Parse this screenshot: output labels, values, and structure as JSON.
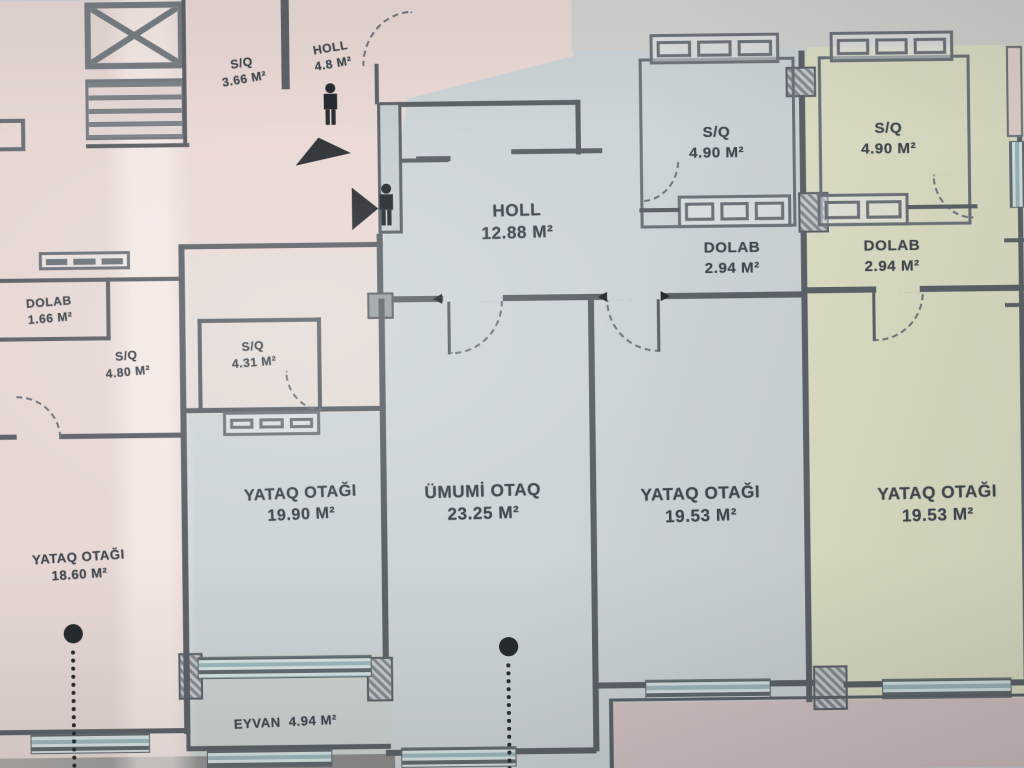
{
  "plan": {
    "title": "Apartment floor plan (photo)",
    "language": "Azerbaijani",
    "colors": {
      "left_apartment_fill": "#ebdad6",
      "center_apartment_fill": "#ced5d8",
      "right_apartment_fill": "#e2e3c6",
      "balcony_fill": "#dac7c7",
      "wall": "#5b6269",
      "text": "#3f464e"
    },
    "icons": {
      "person": "person-silhouette",
      "entry_arrow_up": "triangle-arrow-up",
      "entry_arrow_right": "triangle-arrow-right",
      "column_dot": "column-dot-with-dotted-axis"
    },
    "rooms": [
      {
        "name": "S/Q",
        "area": "3.66 M²"
      },
      {
        "name": "HOLL",
        "area": "4.8 M²"
      },
      {
        "name": "HOLL",
        "area": "12.88 M²"
      },
      {
        "name": "S/Q",
        "area": "4.90 M²"
      },
      {
        "name": "S/Q",
        "area": "4.90 M²"
      },
      {
        "name": "DOLAB",
        "area": "2.94 M²"
      },
      {
        "name": "DOLAB",
        "area": "2.94 M²"
      },
      {
        "name": "DOLAB",
        "area": "1.66 M²"
      },
      {
        "name": "S/Q",
        "area": "4.80 M²"
      },
      {
        "name": "S/Q",
        "area": "4.31 M²"
      },
      {
        "name": "YATAQ OTAĞI",
        "area": "19.90 M²"
      },
      {
        "name": "ÜMUMİ OTAQ",
        "area": "23.25 M²"
      },
      {
        "name": "YATAQ OTAĞI",
        "area": "19.53 M²"
      },
      {
        "name": "YATAQ OTAĞI",
        "area": "19.53 M²"
      },
      {
        "name": "YATAQ OTAĞI",
        "area": "18.60 M²"
      },
      {
        "name": "EYVAN",
        "area": "4.94 M²"
      }
    ]
  }
}
